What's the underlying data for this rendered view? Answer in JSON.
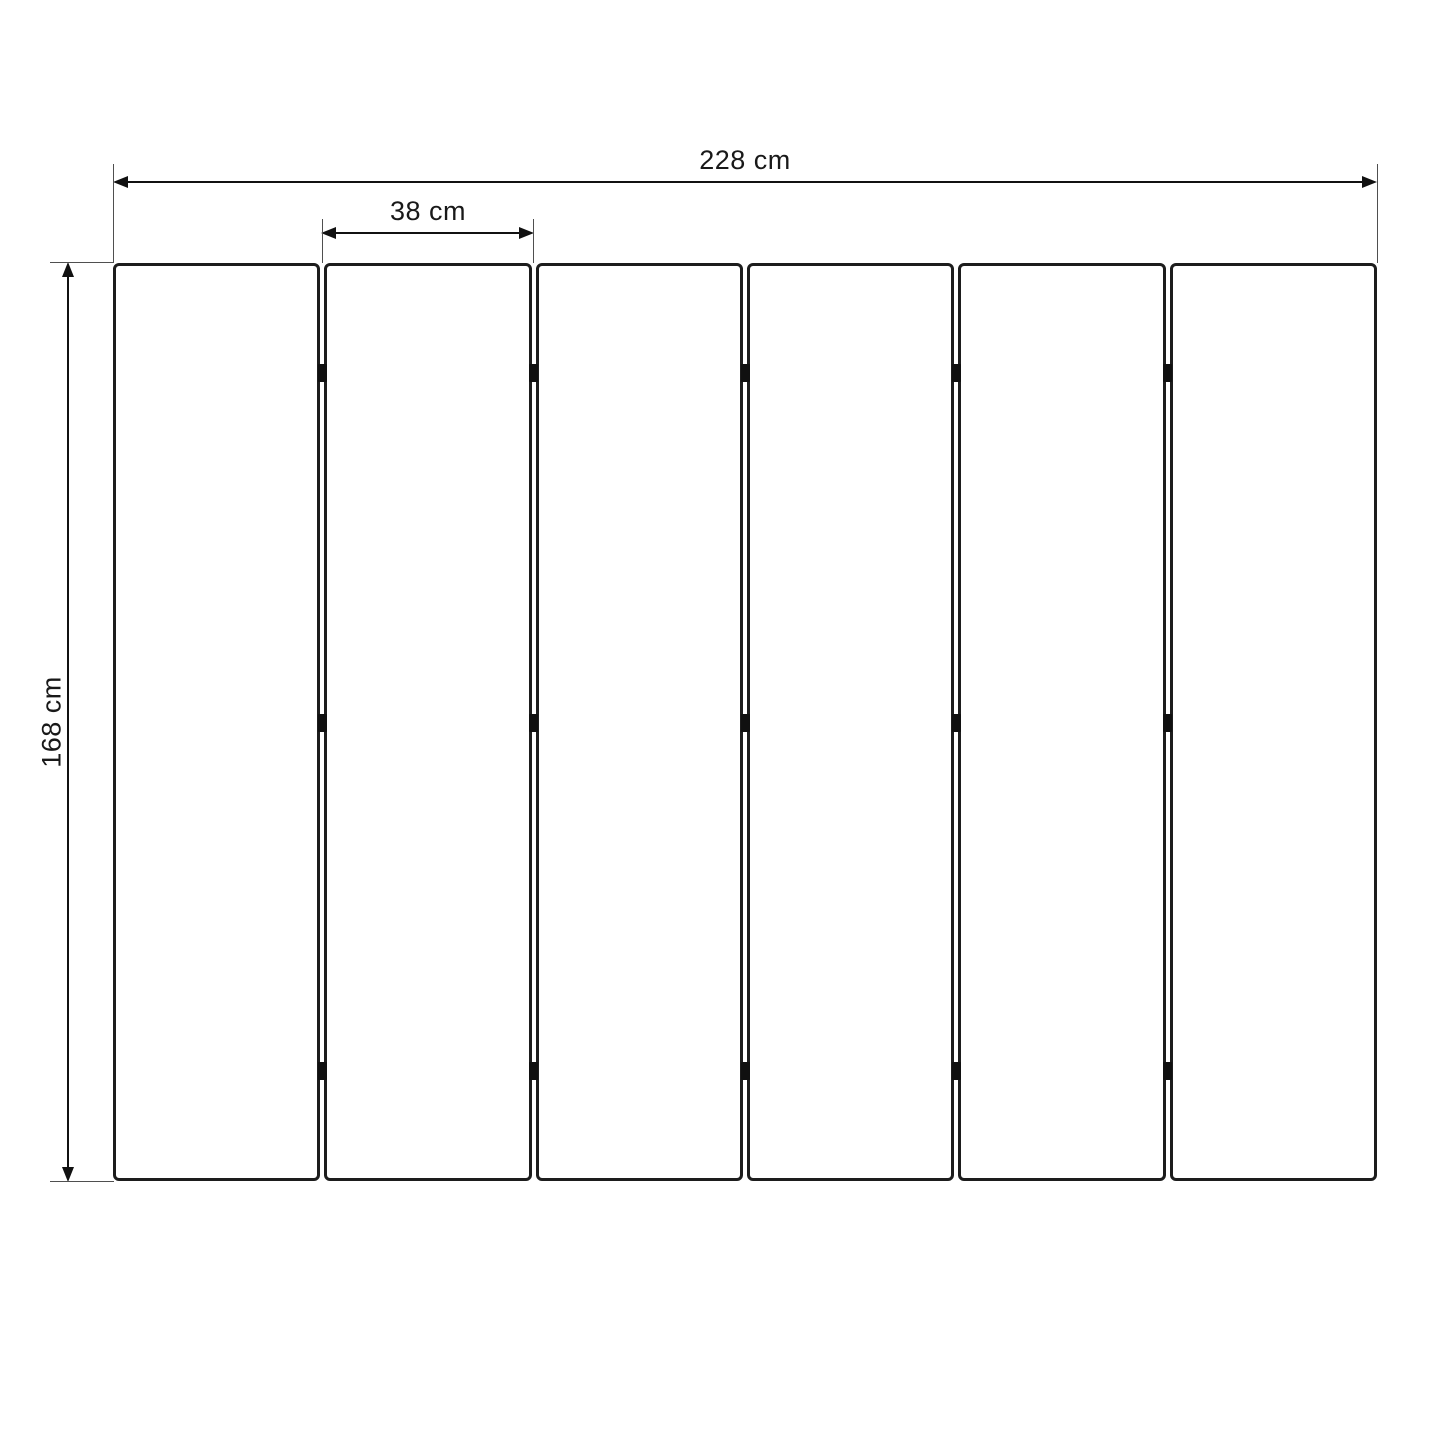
{
  "diagram": {
    "kind": "technical-dimension-drawing",
    "subject": "six-panel layout with width, panel-pitch and height dimensions"
  },
  "dimensions": {
    "total_width_label": "228 cm",
    "panel_width_label": "38 cm",
    "height_label": "168 cm"
  },
  "panels": {
    "count": 6,
    "hinges_per_gap": 3
  },
  "colors": {
    "background": "#ffffff",
    "panel_border": "#1d1d1d",
    "dimension_line": "#111111",
    "extension_line": "#4f4f4f",
    "hinge": "#101010",
    "text": "#191919"
  }
}
